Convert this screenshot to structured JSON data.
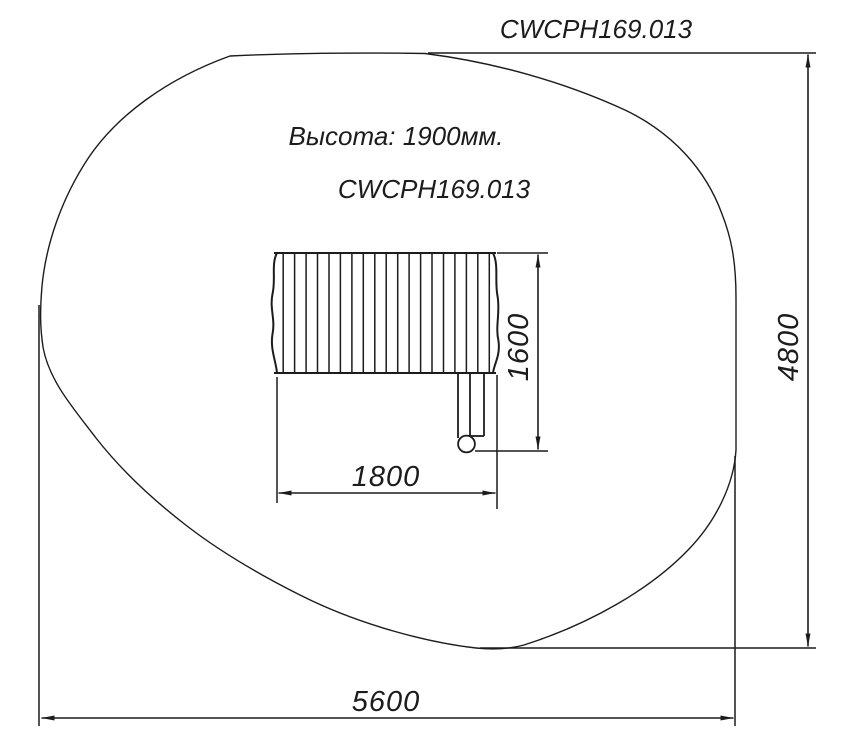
{
  "drawing": {
    "number": "CWCPH169.013",
    "height_note": "Высота: 1900мм.",
    "model_code": "CWCPH169.013"
  },
  "dimensions": {
    "equipment_width_mm": "1800",
    "equipment_depth_mm": "1600",
    "zone_width_mm": "5600",
    "zone_height_mm": "4800"
  },
  "colors": {
    "line": "#1c1c1c",
    "background": "#ffffff"
  }
}
